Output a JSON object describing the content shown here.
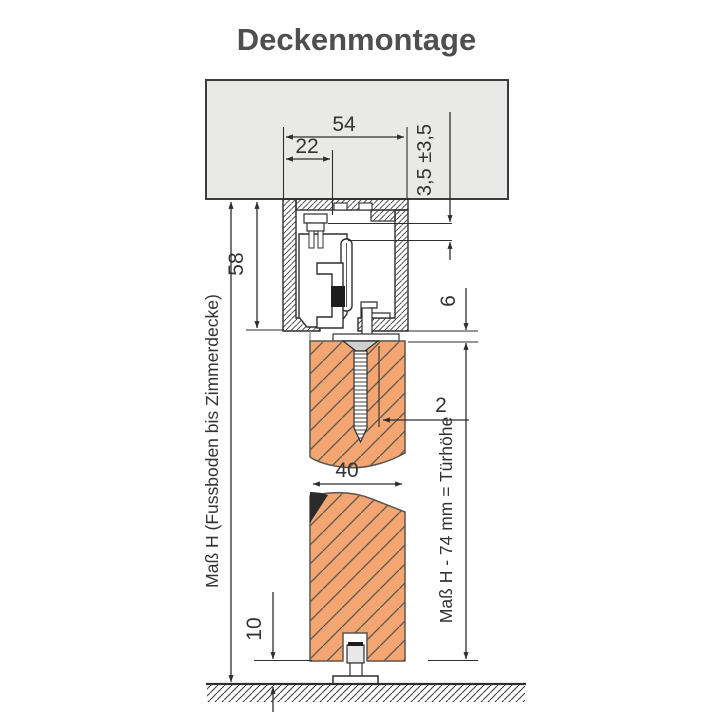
{
  "title": "Deckenmontage",
  "colors": {
    "ceiling": "#e9e9e7",
    "door": "#f3a672",
    "line": "#2e2e2e",
    "title_text": "#4f4f4f"
  },
  "dimensions": {
    "width_54": "54",
    "offset_22": "22",
    "adjust_35": "3,5 ±3,5",
    "height_58": "58",
    "gap_6": "6",
    "thickness_2": "2",
    "door_40": "40",
    "clearance_10": "10",
    "mass_left": "Maß H (Fussboden bis Zimmerdecke)",
    "mass_right": "Maß H - 74 mm = Türhöhe"
  }
}
